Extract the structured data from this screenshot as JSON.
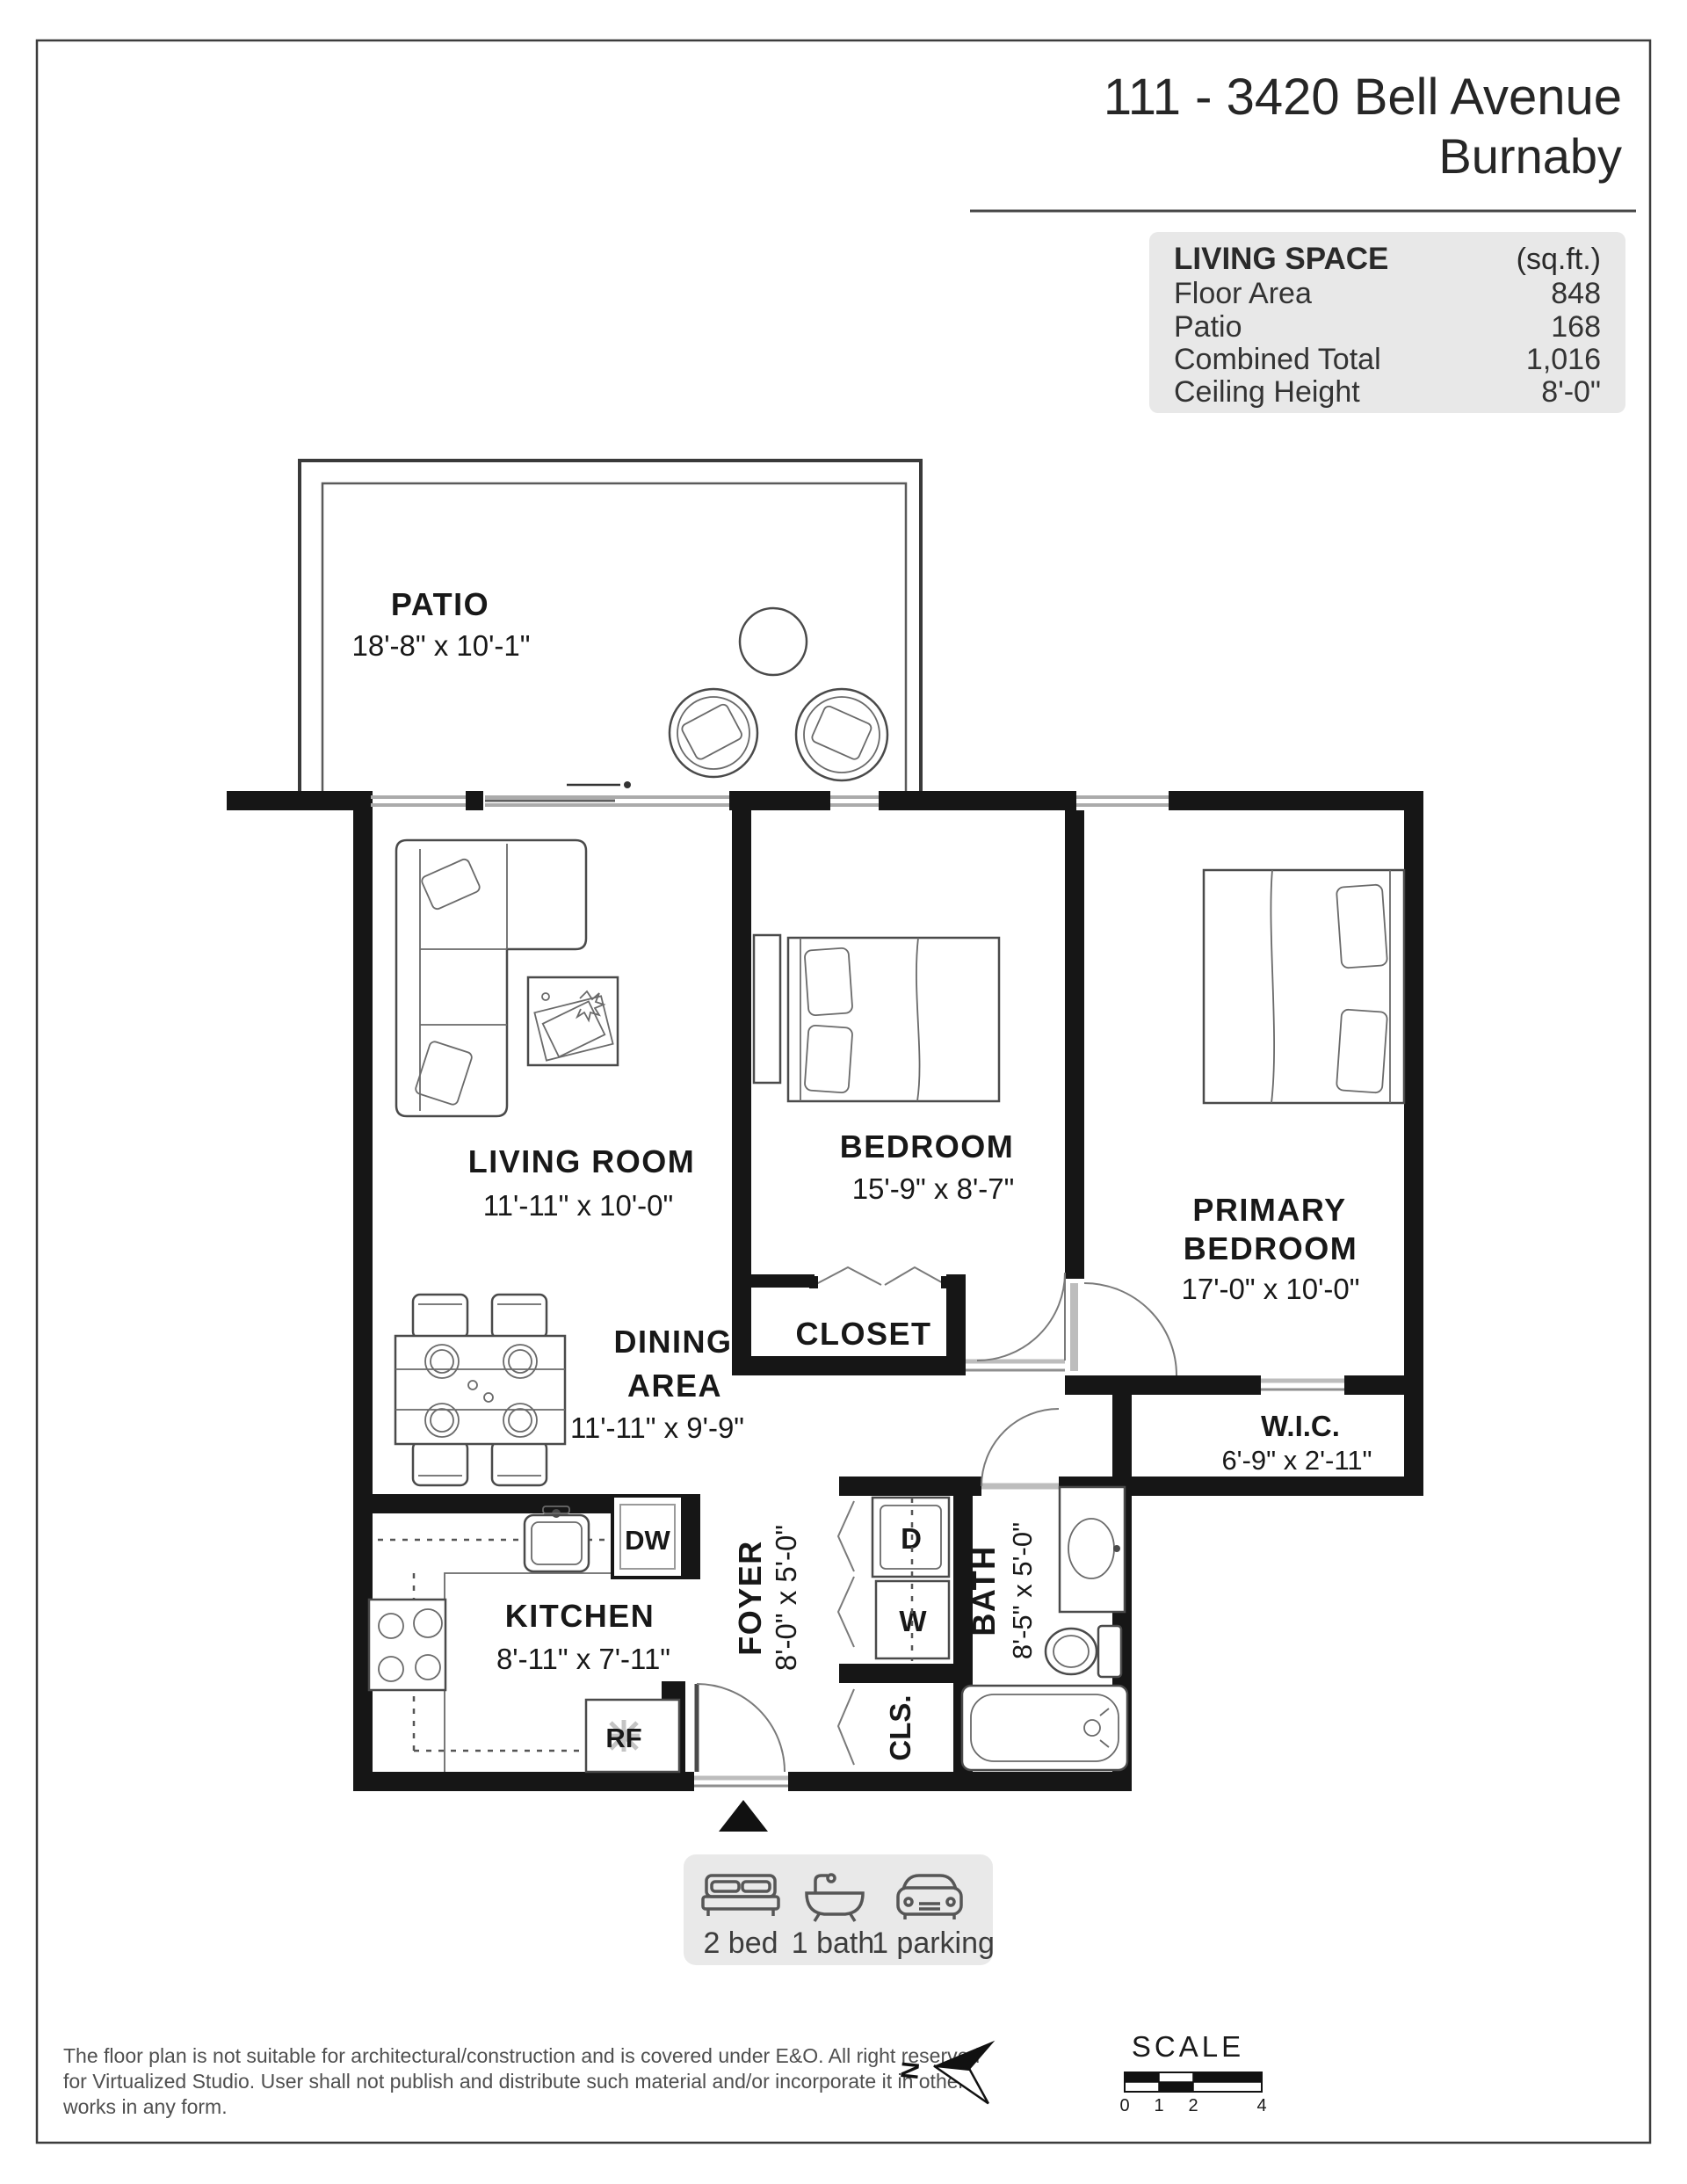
{
  "header": {
    "address": "111 - 3420 Bell Avenue",
    "city": "Burnaby"
  },
  "living_space": {
    "title": "LIVING SPACE",
    "unit_label": "(sq.ft.)",
    "rows": [
      {
        "label": "Floor Area",
        "value": "848"
      },
      {
        "label": "Patio",
        "value": "168"
      },
      {
        "label": "Combined Total",
        "value": "1,016"
      },
      {
        "label": "Ceiling Height",
        "value": "8'-0\""
      }
    ]
  },
  "rooms": {
    "patio": {
      "name": "PATIO",
      "dims": "18'-8\" x 10'-1\""
    },
    "living_room": {
      "name": "LIVING ROOM",
      "dims": "11'-11\" x 10'-0\""
    },
    "bedroom": {
      "name": "BEDROOM",
      "dims": "15'-9\" x 8'-7\""
    },
    "primary_bedroom": {
      "name_line1": "PRIMARY",
      "name_line2": "BEDROOM",
      "dims": "17'-0\" x 10'-0\""
    },
    "closet": {
      "name": "CLOSET"
    },
    "wic": {
      "name": "W.I.C.",
      "dims": "6'-9\" x 2'-11\""
    },
    "dining_area": {
      "name_line1": "DINING",
      "name_line2": "AREA",
      "dims": "11'-11\" x 9'-9\""
    },
    "kitchen": {
      "name": "KITCHEN",
      "dims": "8'-11\" x 7'-11\""
    },
    "foyer": {
      "name": "FOYER",
      "dims": "8'-0\" x 5'-0\""
    },
    "bath": {
      "name": "BATH",
      "dims": "8'-5\" x 5'-0\""
    },
    "dryer_label": "D",
    "washer_label": "W",
    "cls_label": "CLS.",
    "dishwasher_label": "DW",
    "fridge_label": "RF"
  },
  "legend": {
    "items": [
      {
        "icon": "bed-icon",
        "label": "2 bed"
      },
      {
        "icon": "bathtub-icon",
        "label": "1 bath"
      },
      {
        "icon": "car-icon",
        "label": "1 parking"
      }
    ]
  },
  "footer": {
    "disclaimer_line1": "The floor plan is not suitable for architectural/construction and is covered under E&O. All right reserved",
    "disclaimer_line2": "for Virtualized Studio. User shall not publish and distribute such material and/or incorporate it in other",
    "disclaimer_line3": "works in any form.",
    "north_label": "N",
    "scale_title": "SCALE",
    "scale_ticks": [
      "0",
      "1",
      "2",
      "4"
    ]
  },
  "colors": {
    "wall": "#161616",
    "window": "#ababab",
    "panel_bg": "#e8e8e8",
    "text": "#1e1e1e",
    "muted": "#4f4f4f"
  }
}
